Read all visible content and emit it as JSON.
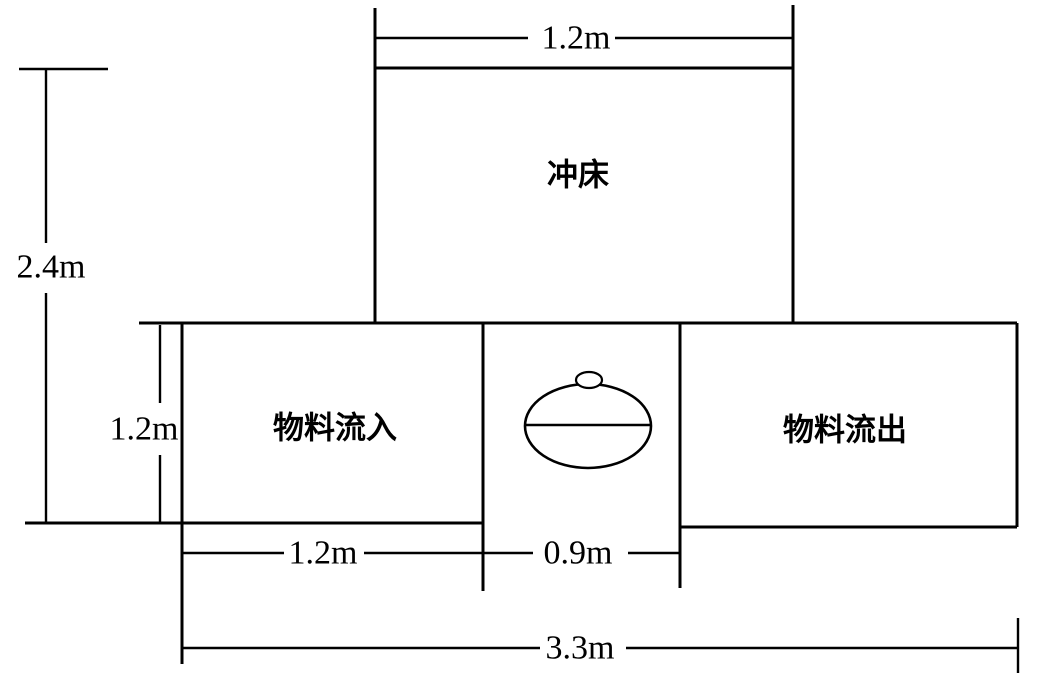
{
  "diagram": {
    "type": "workstation-layout-plan",
    "labels": {
      "machine": "冲床",
      "inflow": "物料流入",
      "outflow": "物料流出"
    },
    "dimensions": {
      "machine_width": "1.2m",
      "total_height": "2.4m",
      "row_height": "1.2m",
      "inflow_width": "1.2m",
      "operator_width": "0.9m",
      "total_width": "3.3m"
    },
    "colors": {
      "line": "#000000",
      "background": "#ffffff"
    }
  }
}
